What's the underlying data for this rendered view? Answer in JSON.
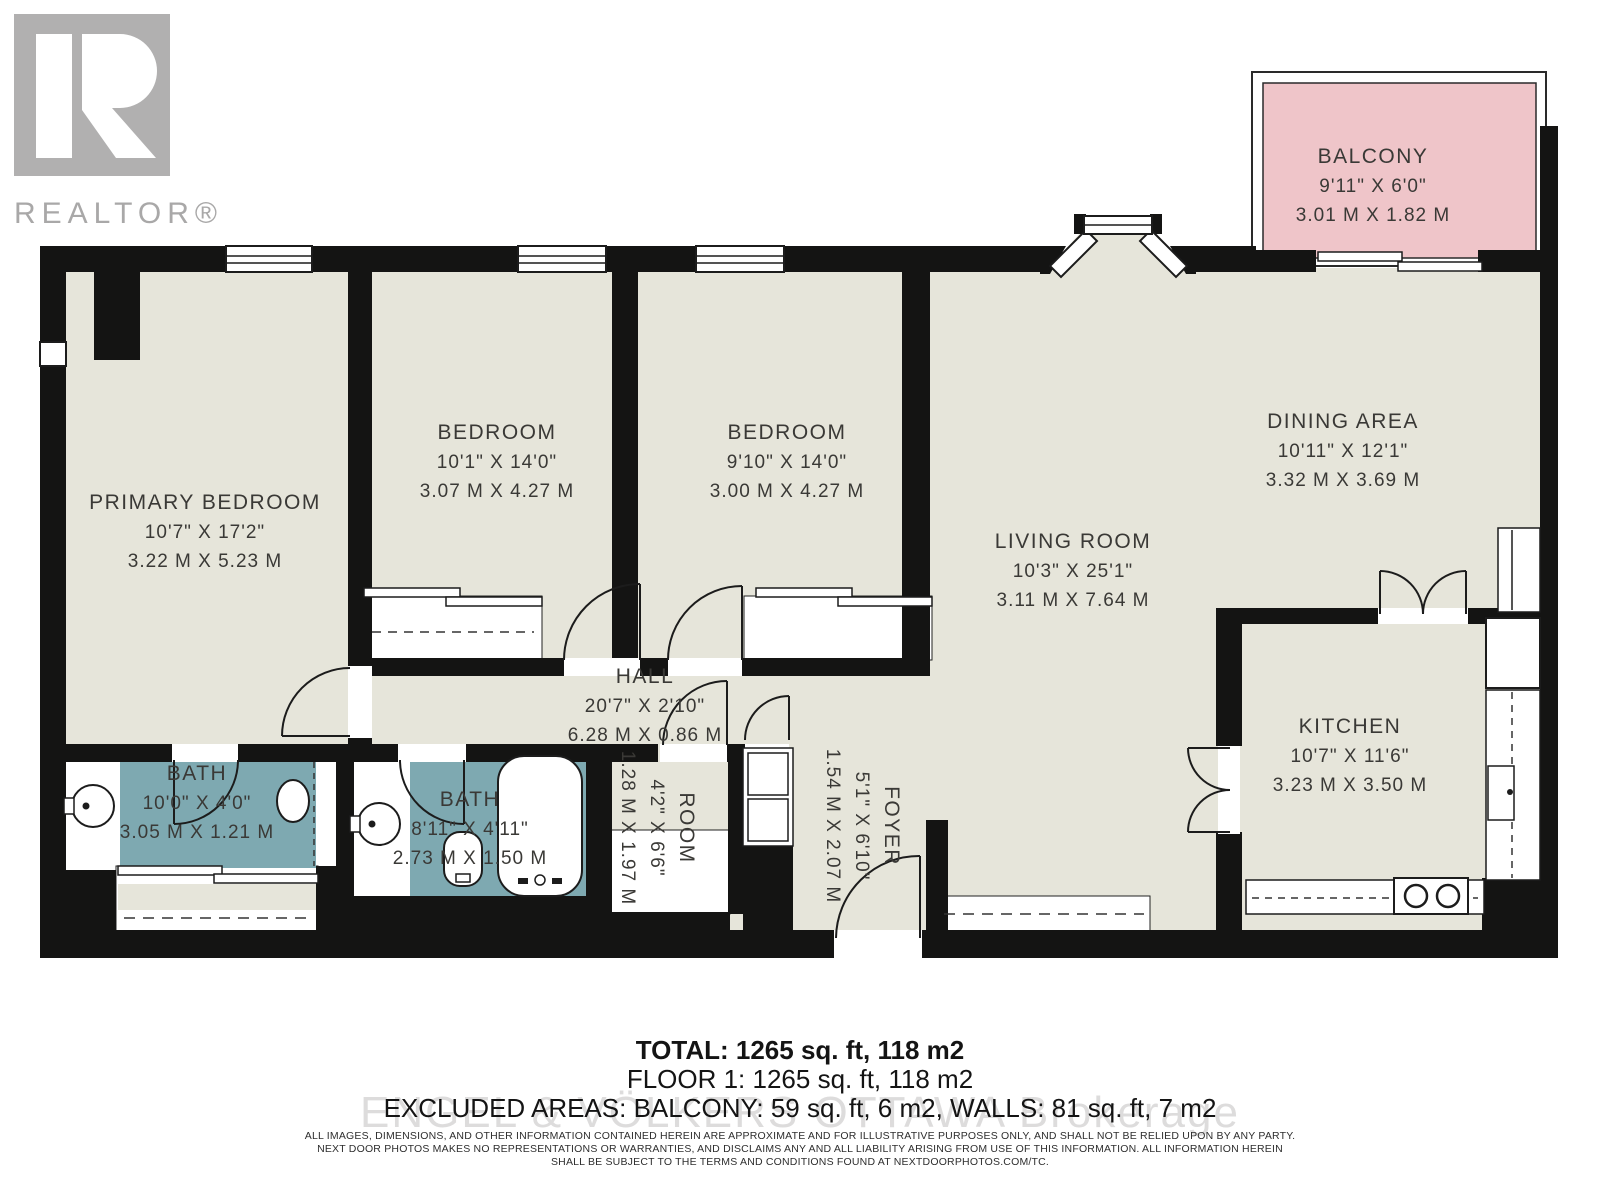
{
  "logo": {
    "brand": "R",
    "word": "REALTOR®"
  },
  "colors": {
    "floor": "#e6e5da",
    "bath": "#7ea9b1",
    "balcony": "#efc5c9",
    "wall": "#141413"
  },
  "rooms": {
    "balcony": {
      "name": "BALCONY",
      "imperial": "9'11\" X 6'0\"",
      "metric": "3.01 M X 1.82 M"
    },
    "primary": {
      "name": "PRIMARY BEDROOM",
      "imperial": "10'7\" X 17'2\"",
      "metric": "3.22 M X 5.23 M"
    },
    "bedroom1": {
      "name": "BEDROOM",
      "imperial": "10'1\" X 14'0\"",
      "metric": "3.07 M X 4.27 M"
    },
    "bedroom2": {
      "name": "BEDROOM",
      "imperial": "9'10\" X 14'0\"",
      "metric": "3.00 M X 4.27 M"
    },
    "dining": {
      "name": "DINING AREA",
      "imperial": "10'11\" X 12'1\"",
      "metric": "3.32 M X 3.69 M"
    },
    "living": {
      "name": "LIVING ROOM",
      "imperial": "10'3\" X 25'1\"",
      "metric": "3.11 M X 7.64 M"
    },
    "kitchen": {
      "name": "KITCHEN",
      "imperial": "10'7\" X 11'6\"",
      "metric": "3.23 M X 3.50 M"
    },
    "hall": {
      "name": "HALL",
      "imperial": "20'7\" X 2'10\"",
      "metric": "6.28 M X 0.86 M"
    },
    "bath1": {
      "name": "BATH",
      "imperial": "10'0\" X 4'0\"",
      "metric": "3.05 M X 1.21 M"
    },
    "bath2": {
      "name": "BATH",
      "imperial": "8'11\" X 4'11\"",
      "metric": "2.73 M X 1.50 M"
    },
    "room": {
      "name": "ROOM",
      "imperial": "4'2\" X 6'6\"",
      "metric": "1.28 M X 1.97 M"
    },
    "foyer": {
      "name": "FOYER",
      "imperial": "5'1\" X 6'10\"",
      "metric": "1.54 M X 2.07 M"
    }
  },
  "summary": {
    "total": "TOTAL: 1265 sq. ft, 118 m2",
    "floor1": "FLOOR 1: 1265 sq. ft, 118 m2",
    "excluded": "EXCLUDED AREAS: BALCONY: 59 sq. ft, 6 m2, WALLS: 81 sq. ft, 7 m2"
  },
  "watermark": "ENGEL & VÖLKERS OTTAWA Brokerage",
  "disclaimer": {
    "line1": "ALL IMAGES, DIMENSIONS, AND OTHER INFORMATION CONTAINED HEREIN ARE APPROXIMATE AND FOR ILLUSTRATIVE PURPOSES ONLY, AND SHALL NOT BE RELIED UPON BY ANY PARTY.",
    "line2": "NEXT DOOR PHOTOS MAKES NO REPRESENTATIONS OR WARRANTIES, AND DISCLAIMS ANY AND ALL LIABILITY ARISING FROM USE OF THIS INFORMATION. ALL INFORMATION HEREIN",
    "line3": "SHALL BE SUBJECT TO THE TERMS AND CONDITIONS FOUND AT NEXTDOORPHOTOS.COM/TC."
  }
}
